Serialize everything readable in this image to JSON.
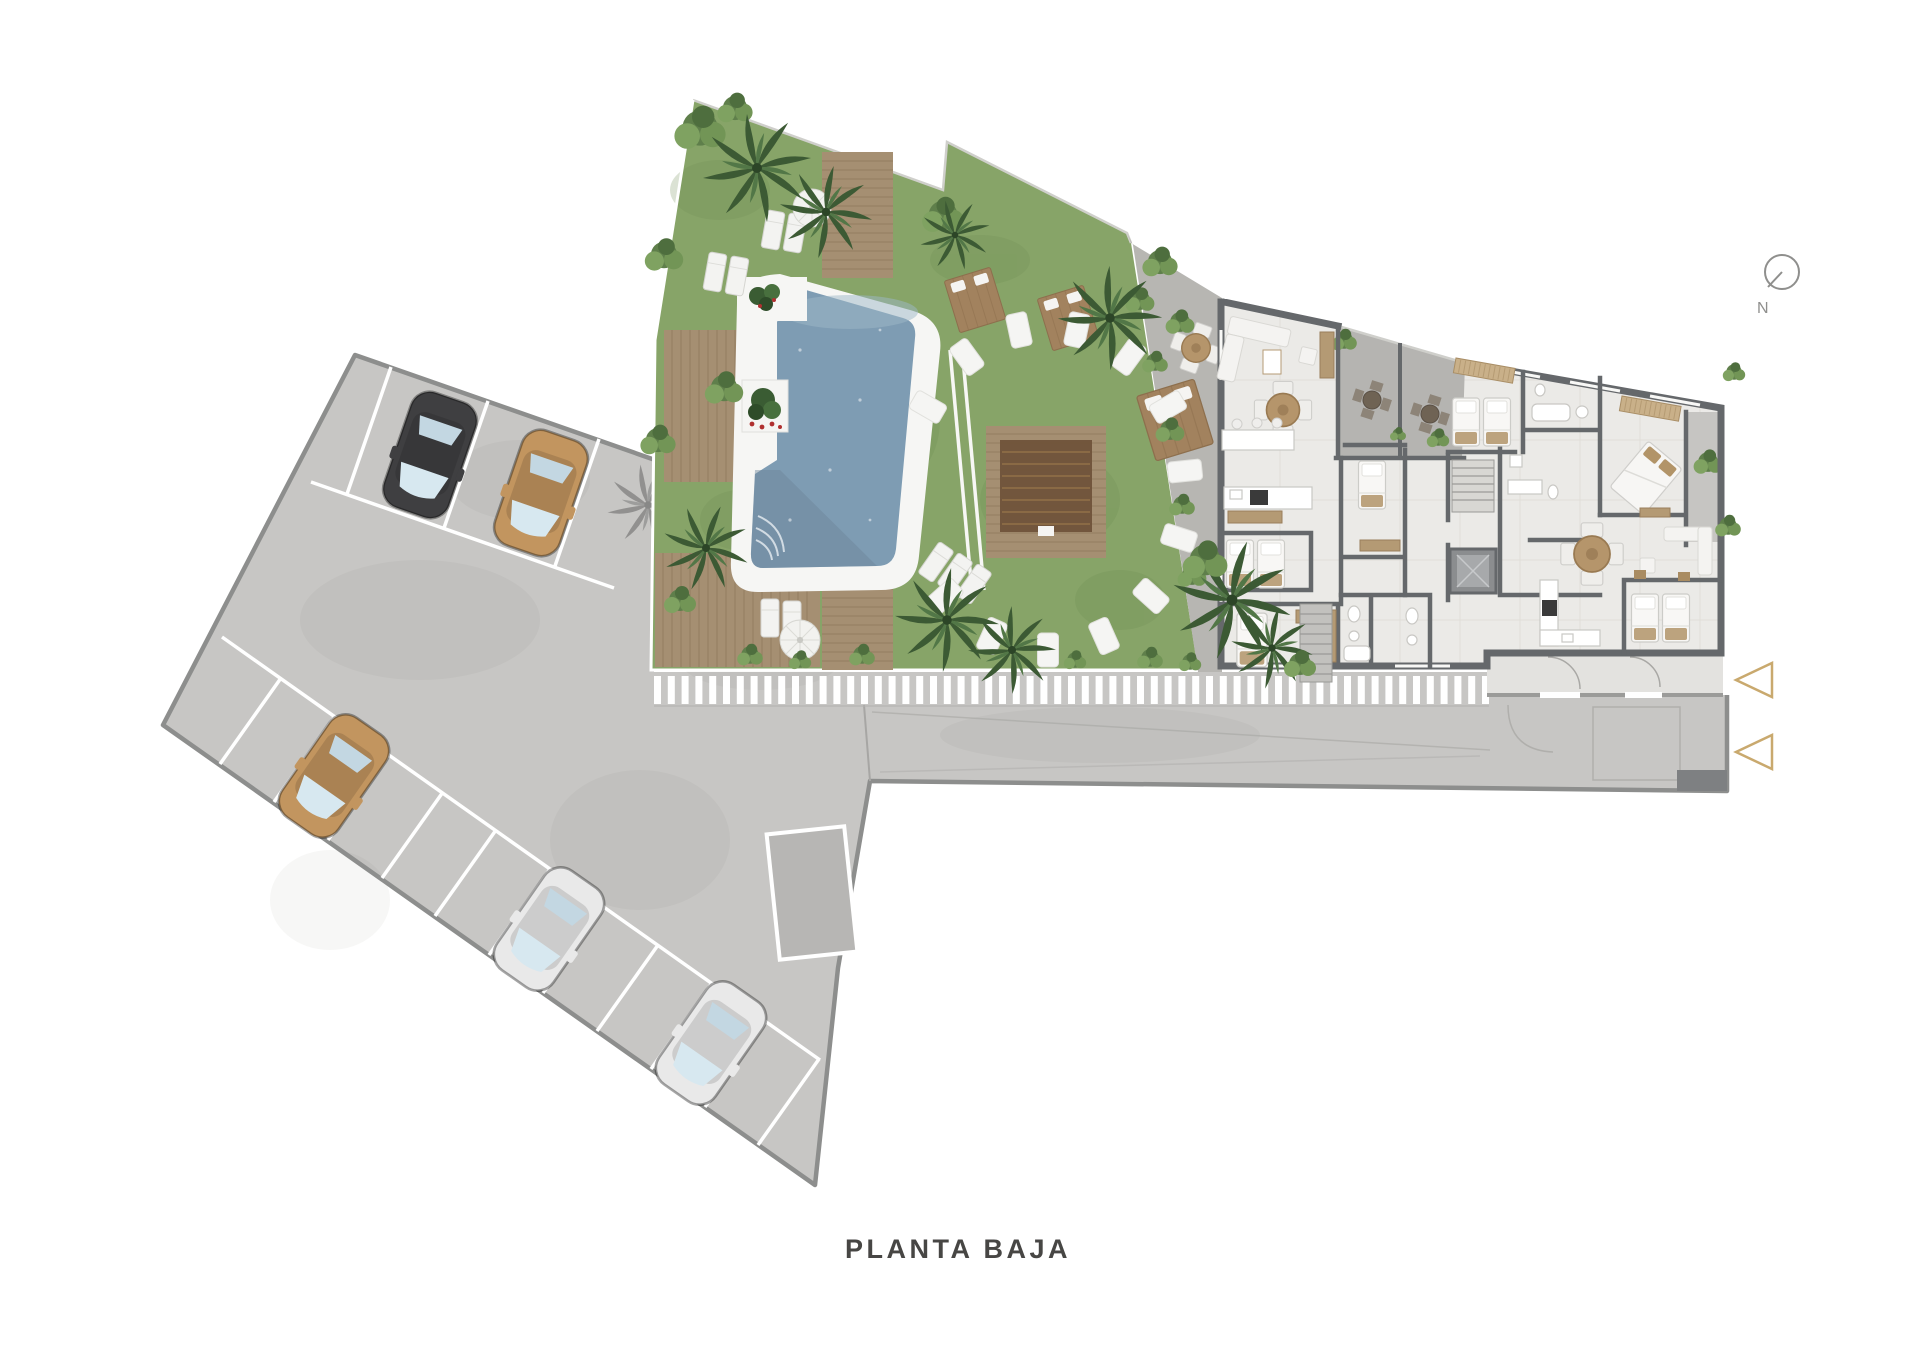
{
  "plan": {
    "title": "PLANTA BAJA",
    "compass_label": "N",
    "colors": {
      "background": "#ffffff",
      "pavement": "#c7c6c4",
      "pavement_marked_space": "#b7b6b4",
      "lot_outline": "#8d8e8d",
      "lawn": "#87a468",
      "deck_wood": "#a58f72",
      "pergola_wood": "#6e5138",
      "pool_border": "#f6f6f4",
      "pool_water": "#7e9cb3",
      "building_floor": "#ebeae7",
      "building_wall": "#65686b",
      "terrace_floor": "#b5b4b1",
      "courtyard": "#b7b6b2",
      "porch_floor": "#e3e2df",
      "fence_white": "#ffffff",
      "entrance_arrow": "#c9a96e",
      "title_color": "#474644",
      "compass_color": "#8f8f8d",
      "car_black": "#3f3f41",
      "car_tan": "#c2955f",
      "car_white": "#e9e9e9"
    },
    "parking": {
      "top_row_spaces": 4,
      "side_row_spaces": 12,
      "marked_spaces": 1,
      "cars": [
        {
          "id": "car-1",
          "color_name": "black",
          "row": "top"
        },
        {
          "id": "car-2",
          "color_name": "tan",
          "row": "top"
        },
        {
          "id": "car-3",
          "color_name": "tan",
          "row": "side"
        },
        {
          "id": "car-4",
          "color_name": "white",
          "row": "side"
        },
        {
          "id": "car-5",
          "color_name": "white",
          "row": "side"
        }
      ]
    },
    "garden": {
      "features": [
        "swimming-pool",
        "wood-decks",
        "palm-trees",
        "sun-loungers",
        "parasols",
        "stepping-stone-arc",
        "planters",
        "pergola",
        "picket-fence",
        "hedges"
      ],
      "stepping_stones": 13,
      "white_loungers": 9,
      "parasols": 2,
      "wood_lounger_pads": 3
    },
    "building": {
      "terrace_table_sets": 2,
      "courtyard_table_sets": 1,
      "entrance_arrows": 2,
      "stair_cores": 1,
      "elevators": 1
    }
  }
}
